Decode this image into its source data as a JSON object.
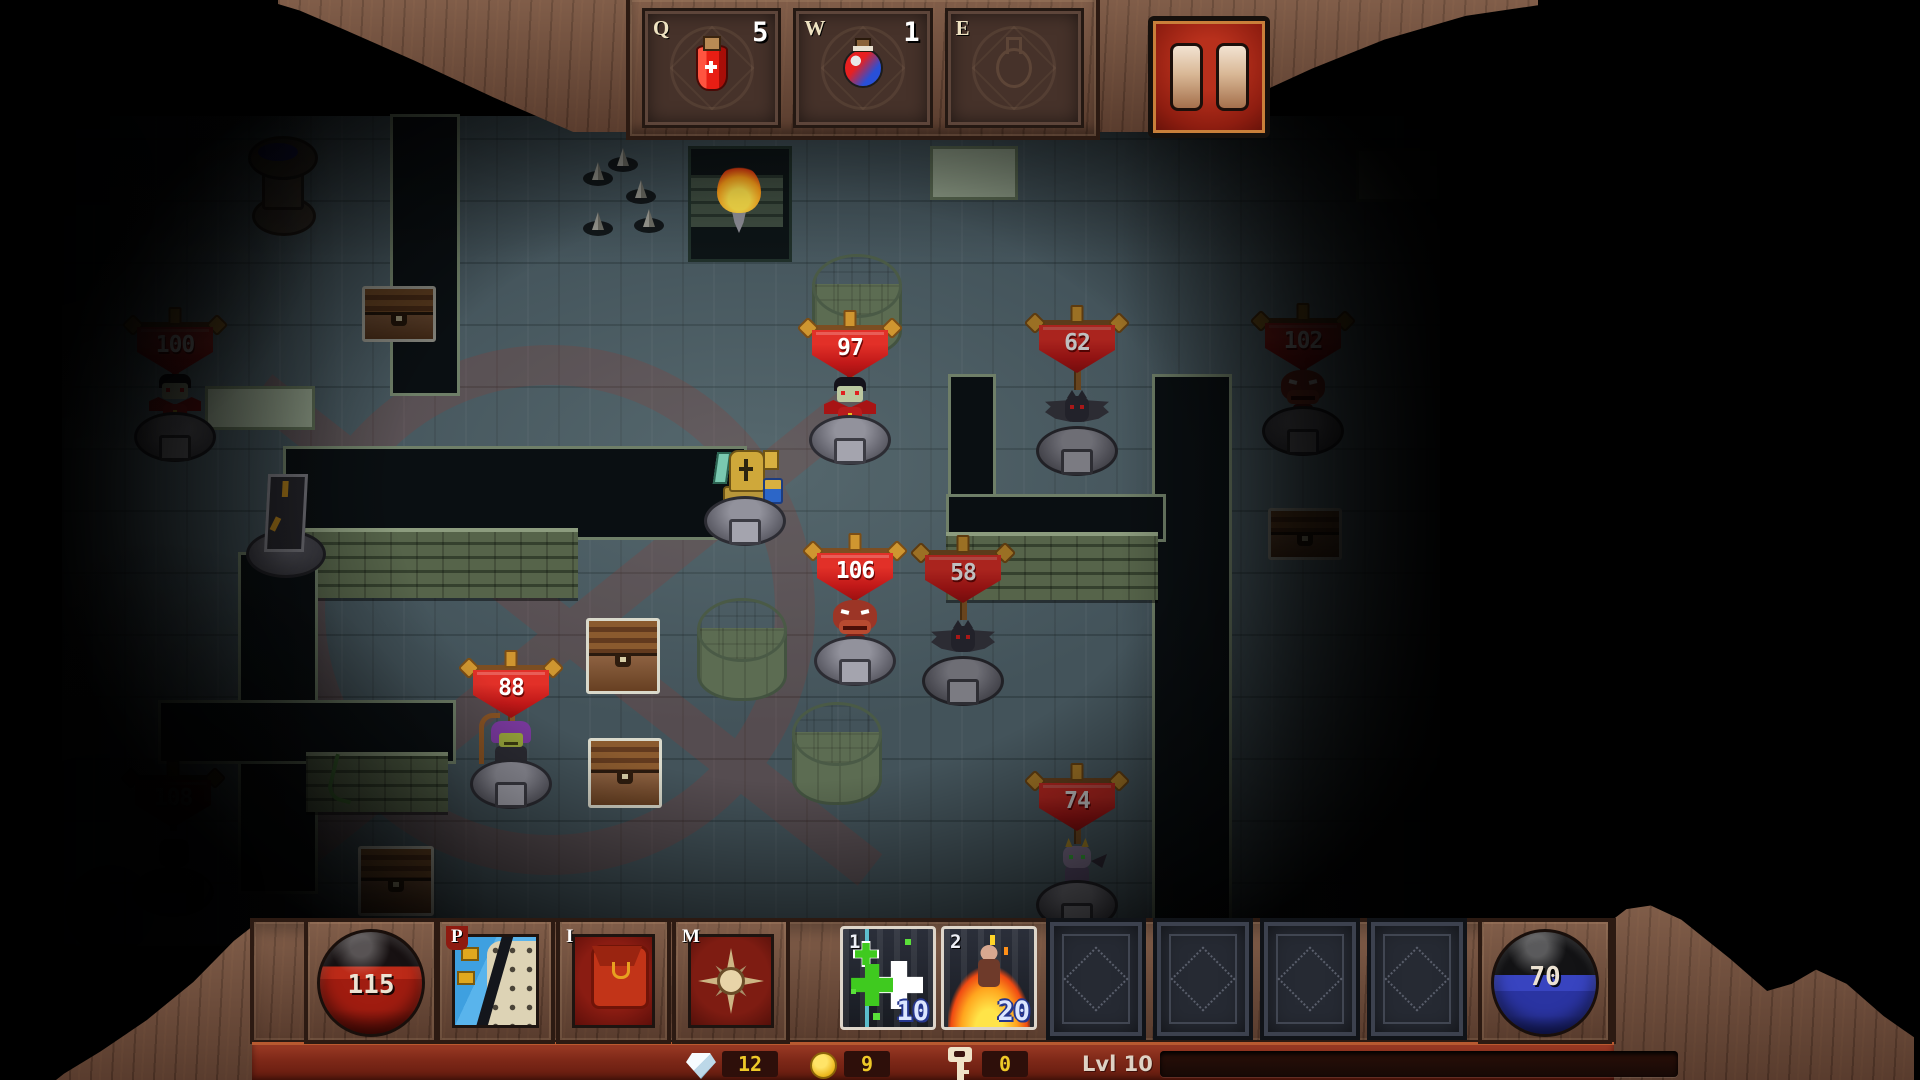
{
  "top_bar": {
    "slots": [
      {
        "hotkey": "Q",
        "count": "5",
        "item": "red-health-potion"
      },
      {
        "hotkey": "W",
        "count": "1",
        "item": "rainbow-potion"
      },
      {
        "hotkey": "E",
        "count": "",
        "item": "empty"
      }
    ],
    "pause_icon": "pause-bars"
  },
  "map": {
    "player": {
      "name": "golden-knight"
    },
    "enemies": [
      {
        "hp": "100",
        "type": "vampire",
        "dim": true
      },
      {
        "hp": "97",
        "type": "vampire",
        "dim": false
      },
      {
        "hp": "62",
        "type": "bat",
        "dim": false
      },
      {
        "hp": "102",
        "type": "demon",
        "dim": true
      },
      {
        "hp": "106",
        "type": "demon",
        "dim": false
      },
      {
        "hp": "58",
        "type": "bat",
        "dim": false
      },
      {
        "hp": "88",
        "type": "goblin-shaman",
        "dim": false
      },
      {
        "hp": "74",
        "type": "imp",
        "dim": true
      },
      {
        "hp": "108",
        "type": "hidden",
        "dim": true
      }
    ],
    "props": [
      "fountain",
      "obelisk",
      "torch",
      "spike-traps",
      "stone-pillars",
      "treasure-chests",
      "red-floor-sigil"
    ]
  },
  "bottom_bar": {
    "health_orb": {
      "value": "115",
      "color": "#a01c10"
    },
    "mana_orb": {
      "value": "70",
      "color": "#2a34a2"
    },
    "menu_buttons": [
      {
        "hotkey": "P",
        "name": "character"
      },
      {
        "hotkey": "I",
        "name": "inventory"
      },
      {
        "hotkey": "M",
        "name": "map"
      }
    ],
    "cards": [
      {
        "hotkey": "1",
        "name": "heal",
        "cost": "10"
      },
      {
        "hotkey": "2",
        "name": "immolation",
        "cost": "20"
      }
    ],
    "empty_card_slots": 4,
    "currencies": {
      "gems": "12",
      "coins": "9",
      "keys": "0"
    },
    "level_label": "Lvl 10"
  },
  "colors": {
    "banner_red": "#c01818",
    "ui_wood": "#6f4b39",
    "pause_red": "#8e1d10",
    "floor": "#43535a"
  }
}
